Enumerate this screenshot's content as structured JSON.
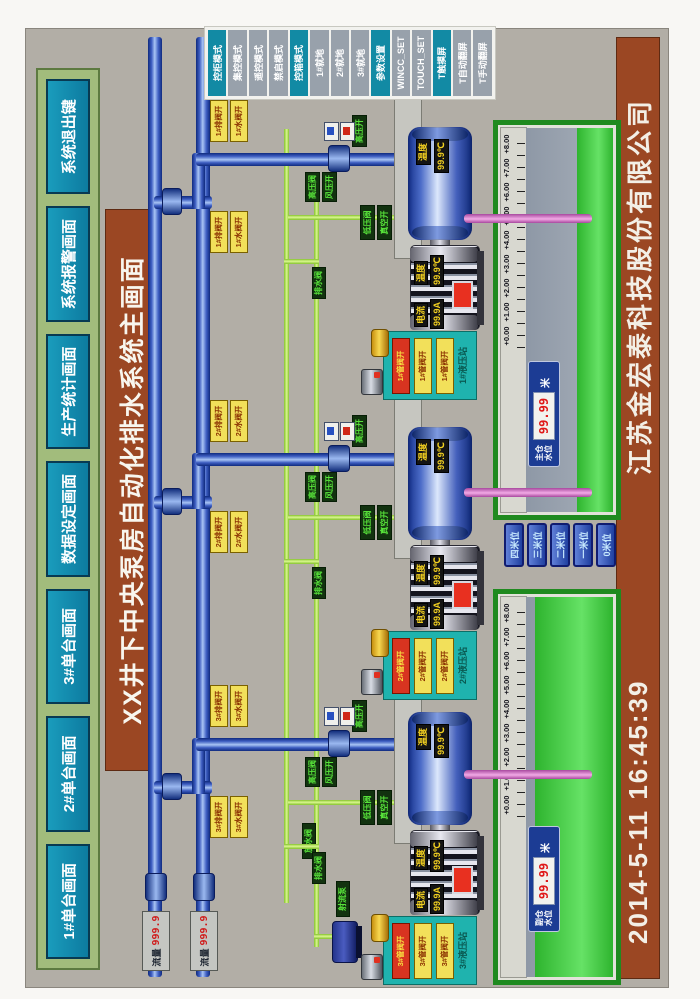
{
  "header": {
    "title": "XX井下中央泵房自动化排水系统主画面",
    "company": "江苏金宏泰科技股份有限公司",
    "date": "2014-5-11",
    "time": "16:45:39"
  },
  "toolbar": {
    "buttons": [
      "1#单台画面",
      "2#单台画面",
      "3#单台画面",
      "数据设定画面",
      "生产统计画面",
      "系统报警画面",
      "系统退出键"
    ]
  },
  "menu": {
    "items": [
      {
        "label": "控柜模式",
        "active": true
      },
      {
        "label": "集控模式",
        "active": false
      },
      {
        "label": "遥控模式",
        "active": false
      },
      {
        "label": "禁启模式",
        "active": false
      },
      {
        "label": "控箱模式",
        "active": true
      },
      {
        "label": "1#就地",
        "active": false
      },
      {
        "label": "2#就地",
        "active": false
      },
      {
        "label": "3#就地",
        "active": false
      },
      {
        "label": "参数设置",
        "active": true
      },
      {
        "label": "WINCC_SET",
        "active": false
      },
      {
        "label": "TOUCH_SET",
        "active": false
      },
      {
        "label": "T触摸屏",
        "active": true
      },
      {
        "label": "T自动翻屏",
        "active": false
      },
      {
        "label": "T手动翻屏",
        "active": false
      }
    ]
  },
  "flow_meters": [
    {
      "label": "流量",
      "value": "999.9"
    },
    {
      "label": "流量",
      "value": "999.9"
    }
  ],
  "units": [
    {
      "id": "1#",
      "va0": "1#排阀开",
      "va1": "1#水阀开",
      "vb0": "1#排阀开",
      "vb1": "1#水阀开",
      "hp0": "高压阀",
      "hp1": "风压开",
      "lp0": "低压阀",
      "lp1": "真空开",
      "drain": "排水阀",
      "disch": "高压开",
      "pt_l": "温度",
      "pt_v": "99.9℃",
      "mc_l": "电流",
      "mc_v": "99.9A",
      "mt_l": "温度",
      "mt_v": "99.9℃",
      "st0": "1#管阀开",
      "st1": "1#管阀开",
      "st2": "1#管阀开",
      "st_name": "1#液压站"
    },
    {
      "id": "2#",
      "va0": "2#排阀开",
      "va1": "2#水阀开",
      "vb0": "2#排阀开",
      "vb1": "2#水阀开",
      "hp0": "高压阀",
      "hp1": "风压开",
      "lp0": "低压阀",
      "lp1": "真空开",
      "drain": "排水阀",
      "disch": "高压开",
      "pt_l": "温度",
      "pt_v": "99.9℃",
      "mc_l": "电流",
      "mc_v": "99.9A",
      "mt_l": "温度",
      "mt_v": "99.9℃",
      "st0": "2#管阀开",
      "st1": "2#管阀开",
      "st2": "2#管阀开",
      "st_name": "2#液压站"
    },
    {
      "id": "3#",
      "va0": "3#排阀开",
      "va1": "3#水阀开",
      "vb0": "3#排阀开",
      "vb1": "3#水阀开",
      "hp0": "高压阀",
      "hp1": "风压开",
      "lp0": "低压阀",
      "lp1": "真空开",
      "drain": "排水阀",
      "disch": "高压开",
      "pt_l": "温度",
      "pt_v": "99.9℃",
      "mc_l": "电流",
      "mc_v": "99.9A",
      "mt_l": "温度",
      "mt_v": "99.9℃",
      "st0": "3#管阀开",
      "st1": "3#管阀开",
      "st2": "3#管阀开",
      "st_name": "3#液压站"
    }
  ],
  "sumps": [
    {
      "name": "主仓水位",
      "value": "99.99",
      "unit": "米",
      "scale": [
        "+8.00",
        "+7.00",
        "+6.00",
        "+5.00",
        "+4.00",
        "+3.00",
        "+2.00",
        "+1.00",
        "+0.00"
      ]
    },
    {
      "name": "副仓水位",
      "value": "99.99",
      "unit": "米",
      "scale": [
        "+8.00",
        "+7.00",
        "+6.00",
        "+5.00",
        "+4.00",
        "+3.00",
        "+2.00",
        "+1.00",
        "+0.00"
      ]
    }
  ],
  "level_buttons": [
    "四米位",
    "三米位",
    "二米位",
    "一米位",
    "0米位"
  ],
  "misc": {
    "jet_pump": "射流泵",
    "release_valve": "放水阀"
  },
  "colors": {
    "accent_teal": "#0d87a6",
    "bar_brown": "#9b4723",
    "toolbar_green": "#a2bc7c",
    "pipe_blue": "#3c5cc0",
    "pipe_green": "#a6d83e",
    "pipe_pink": "#f2aae6",
    "alarm_red": "#e83020",
    "led_red": "#e01818"
  }
}
